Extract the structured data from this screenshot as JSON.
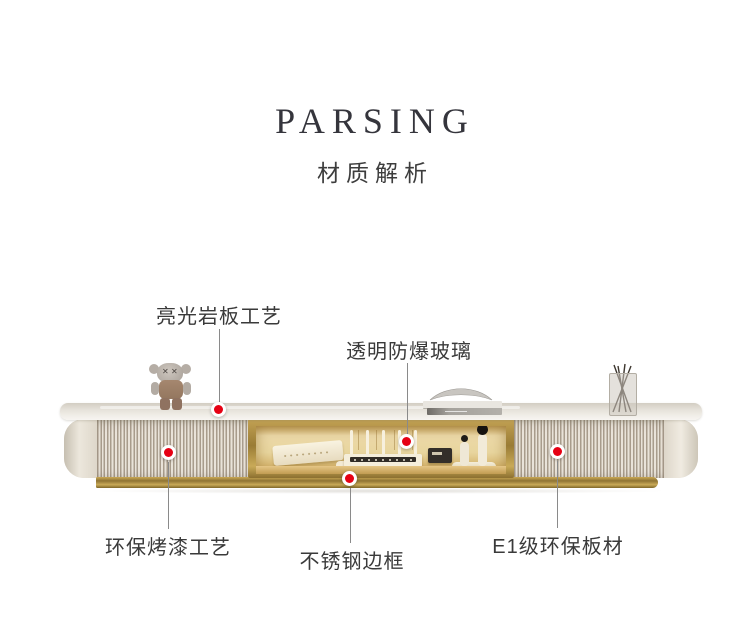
{
  "header": {
    "title": "PARSING",
    "subtitle": "材质解析"
  },
  "annotations": [
    {
      "id": "glossy-slate-top",
      "label": "亮光岩板工艺"
    },
    {
      "id": "shatterproof-glass",
      "label": "透明防爆玻璃"
    },
    {
      "id": "eco-baked-paint",
      "label": "环保烤漆工艺"
    },
    {
      "id": "stainless-steel-frame",
      "label": "不锈钢边框"
    },
    {
      "id": "e1-eco-board",
      "label": "E1级环保板材"
    }
  ],
  "colors": {
    "background": "#ffffff",
    "marker_red": "#e60114",
    "marker_ring": "#ffffff",
    "leader_line": "#8a8a8a",
    "text": "#3a3a3a",
    "gold_trim": "#9a7c35",
    "cabinet_cream": "#d9d1c4",
    "glass_glow": "#ecd9a8"
  },
  "scene": {
    "product": "tv-stand-cabinet",
    "decor_items": [
      "kaws-figure",
      "book-stack",
      "metal-dish",
      "branch-vase"
    ],
    "shelf_items": [
      "set-top-box",
      "ice-cubes",
      "wifi-router",
      "camera-speaker",
      "microphone-stand"
    ]
  }
}
